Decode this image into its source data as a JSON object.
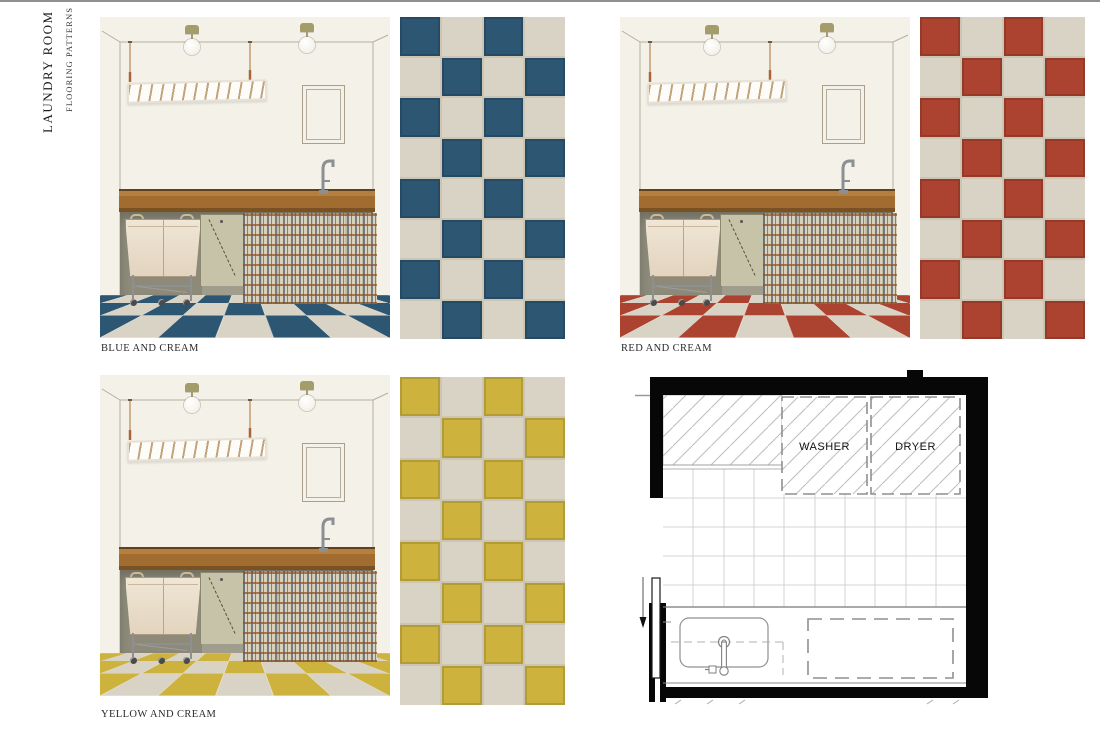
{
  "header": {
    "title": "LAUNDRY ROOM",
    "subtitle": "FLOORING PATTERNS"
  },
  "options": [
    {
      "id": "blue-and-cream",
      "label": "BLUE AND CREAM",
      "tile_color": "#2d5673"
    },
    {
      "id": "red-and-cream",
      "label": "RED AND CREAM",
      "tile_color": "#ac4330"
    },
    {
      "id": "yellow-and-cream",
      "label": "YELLOW AND CREAM",
      "tile_color": "#ceb23e"
    }
  ],
  "shared": {
    "cream_tile_color": "#d8d3c5",
    "swatch_columns": 4,
    "swatch_rows": 8
  },
  "floor_plan": {
    "washer_label": "WASHER",
    "dryer_label": "DRYER"
  }
}
